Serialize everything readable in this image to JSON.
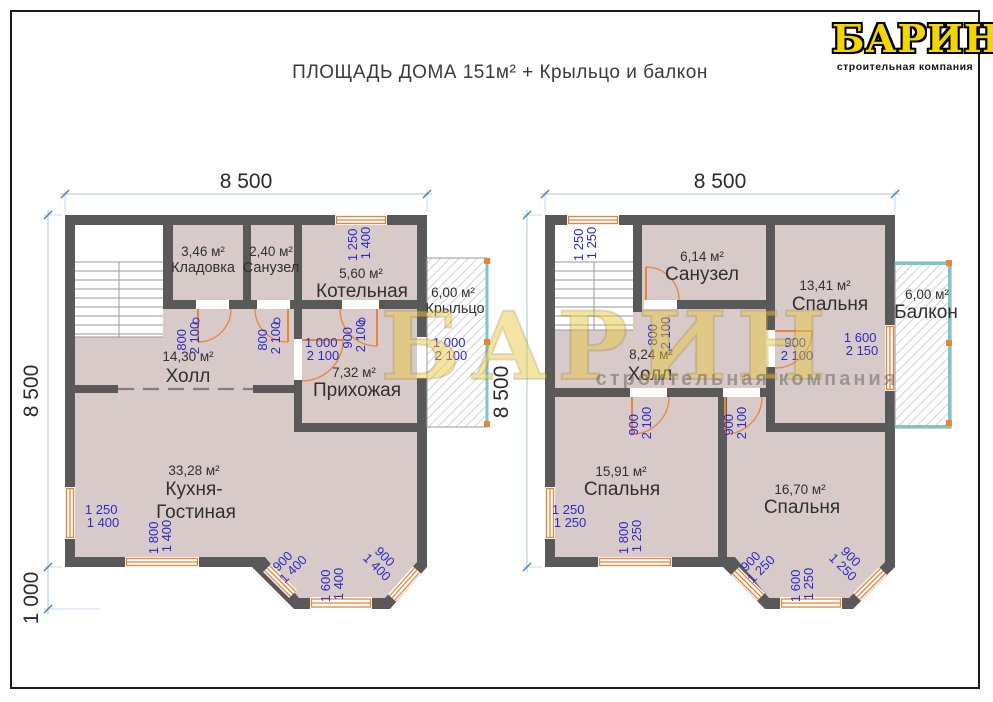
{
  "title": "ПЛОЩАДЬ ДОМА 151м² + Крыльцо и балкон",
  "logo": {
    "name": "БАРИН",
    "tagline": "строительная компания"
  },
  "watermark": {
    "name": "БАРИН",
    "tagline": "строительная компания"
  },
  "colors": {
    "wall": "#595959",
    "room_fill": "#d9caca",
    "opening_accent": "#e8843c",
    "dim_blue_text": "#2a2ac8",
    "railing": "#7cc6c6",
    "logo_yellow": "#f3d600"
  },
  "floor1": {
    "dim_top": "8 500",
    "dim_left": "8 500",
    "dim_left_lower": "1 000",
    "rooms": {
      "storage": {
        "area": "3,46 м²",
        "name": "Кладовка"
      },
      "bathroom": {
        "area": "2,40 м²",
        "name": "Санузел"
      },
      "boiler": {
        "area": "5,60 м²",
        "name": "Котельная"
      },
      "hall": {
        "area": "14,30 м²",
        "name": "Холл"
      },
      "entry": {
        "area": "7,32 м²",
        "name": "Прихожая"
      },
      "kitchen": {
        "area": "33,28 м²",
        "name1": "Кухня-",
        "name2": "Гостиная"
      },
      "porch": {
        "area": "6,00 м²",
        "name": "Крыльцо"
      }
    },
    "openings": {
      "boiler_window": {
        "w": "1 250",
        "h": "1 400"
      },
      "storage_door": {
        "w": "800",
        "h": "2 100"
      },
      "bath_door": {
        "w": "800",
        "h": "2 100"
      },
      "boiler_door": {
        "w": "900",
        "h": "2 100"
      },
      "entry_door": {
        "w": "1 000",
        "h": "2 100"
      },
      "porch_door": {
        "w": "1 000",
        "h": "2 100"
      },
      "kitchen_window_left": {
        "w": "1 250",
        "h": "1 400"
      },
      "kitchen_window_bottom": {
        "w": "1 800",
        "h": "1 400"
      },
      "bay_window_left": {
        "w": "900",
        "h": "1 400"
      },
      "bay_window_center": {
        "w": "1 600",
        "h": "1 400"
      },
      "bay_window_right": {
        "w": "900",
        "h": "1 400"
      }
    }
  },
  "floor2": {
    "dim_top": "8 500",
    "dim_left": "8 500",
    "rooms": {
      "bathroom": {
        "area": "6,14 м²",
        "name": "Санузел"
      },
      "bedroom1": {
        "area": "13,41 м²",
        "name": "Спальня"
      },
      "hall": {
        "area": "8,24 м²",
        "name": "Холл"
      },
      "bedroom2": {
        "area": "15,91 м²",
        "name": "Спальня"
      },
      "bedroom3": {
        "area": "16,70 м²",
        "name": "Спальня"
      },
      "balcony": {
        "area": "6,00 м²",
        "name": "Балкон"
      }
    },
    "openings": {
      "stairs_window": {
        "w": "1 250",
        "h": "1 250"
      },
      "bath_door": {
        "w": "800",
        "h": "2 100"
      },
      "bedroom1_door": {
        "w": "900",
        "h": "2 100"
      },
      "balcony_door": {
        "w": "1 600",
        "h": "2 150"
      },
      "hall_door_left": {
        "w": "900",
        "h": "2 100"
      },
      "hall_door_right": {
        "w": "900",
        "h": "2 100"
      },
      "bedroom2_window_left": {
        "w": "1 250",
        "h": "1 250"
      },
      "bedroom2_window_bottom": {
        "w": "1 800",
        "h": "1 250"
      },
      "bay_window_left": {
        "w": "900",
        "h": "1 250"
      },
      "bay_window_center": {
        "w": "1 600",
        "h": "1 250"
      },
      "bay_window_right": {
        "w": "900",
        "h": "1 250"
      }
    }
  }
}
